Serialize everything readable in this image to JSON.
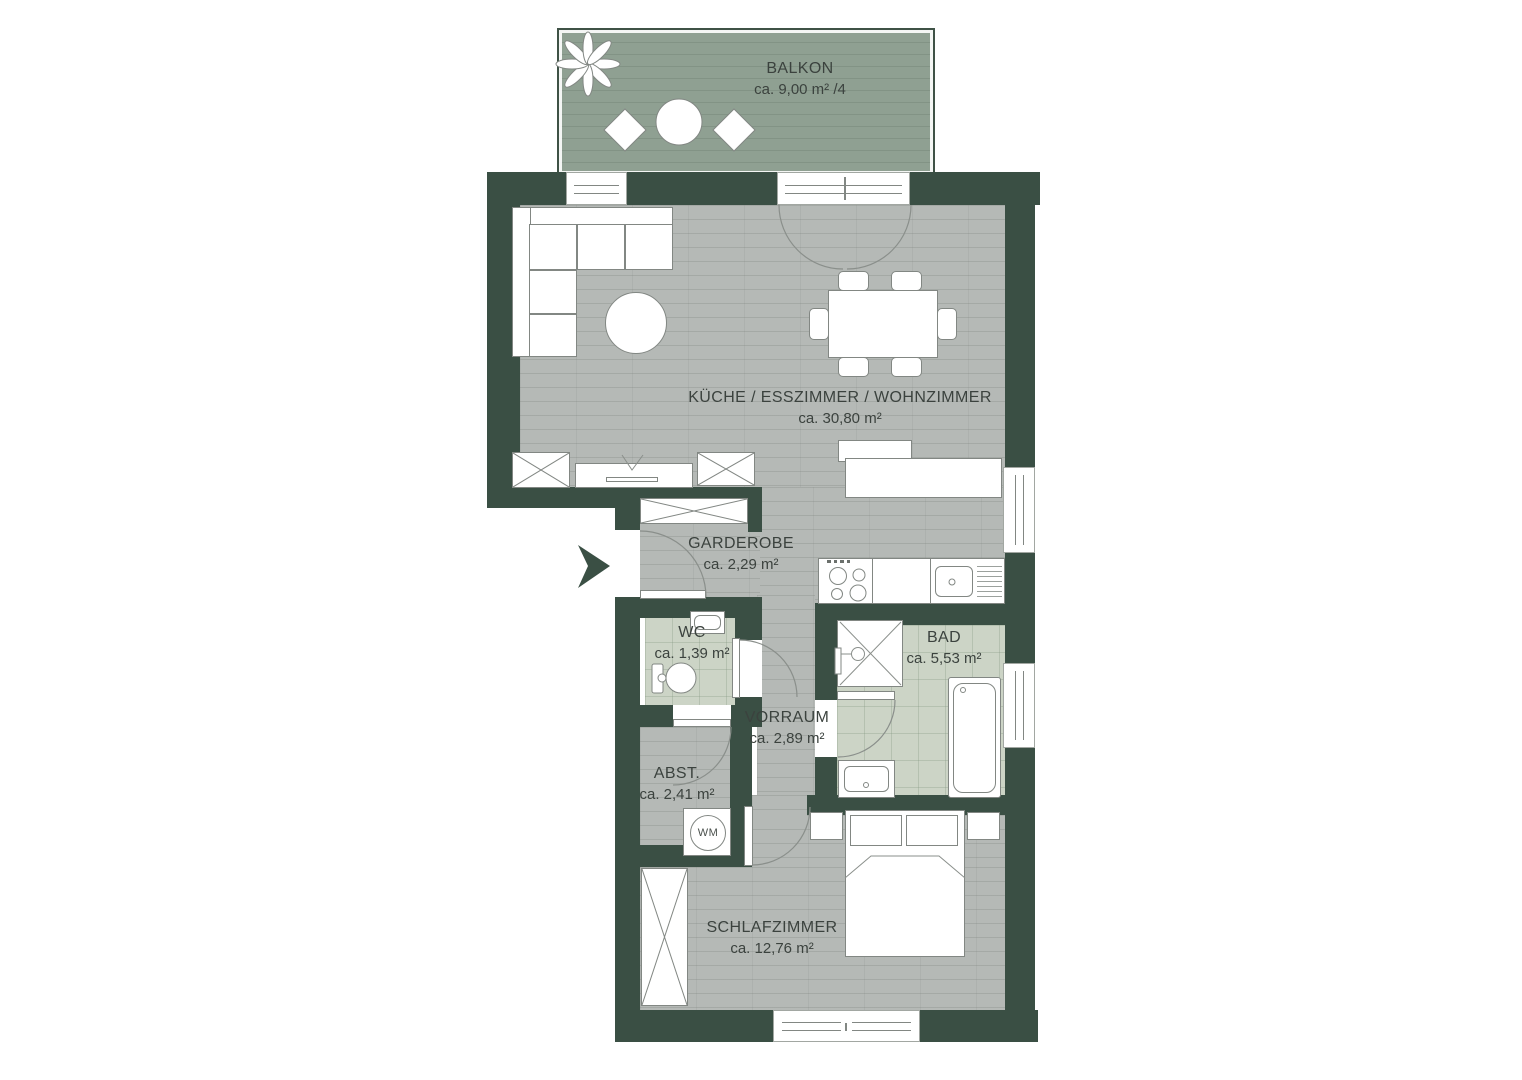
{
  "colors": {
    "wall": "#3a4f44",
    "floor": "#b5b9b6",
    "balcony": "#8fa092",
    "sage": "#ccd4c6",
    "stroke": "#828783",
    "text": "#3b423e"
  },
  "rooms": [
    {
      "id": "balkon",
      "name": "BALKON",
      "area": "ca. 9,00 m² /4"
    },
    {
      "id": "wohnzimmer",
      "name": "KÜCHE / ESSZIMMER / WOHNZIMMER",
      "area": "ca. 30,80 m²"
    },
    {
      "id": "garderobe",
      "name": "GARDEROBE",
      "area": "ca. 2,29 m²"
    },
    {
      "id": "wc",
      "name": "WC",
      "area": "ca. 1,39 m²"
    },
    {
      "id": "bad",
      "name": "BAD",
      "area": "ca. 5,53 m²"
    },
    {
      "id": "vorraum",
      "name": "VORRAUM",
      "area": "ca. 2,89 m²"
    },
    {
      "id": "abstellraum",
      "name": "ABST.",
      "area": "ca. 2,41 m²"
    },
    {
      "id": "schlafzimmer",
      "name": "SCHLAFZIMMER",
      "area": "ca. 12,76 m²"
    }
  ],
  "appliances": {
    "washing_machine_label": "WM"
  }
}
